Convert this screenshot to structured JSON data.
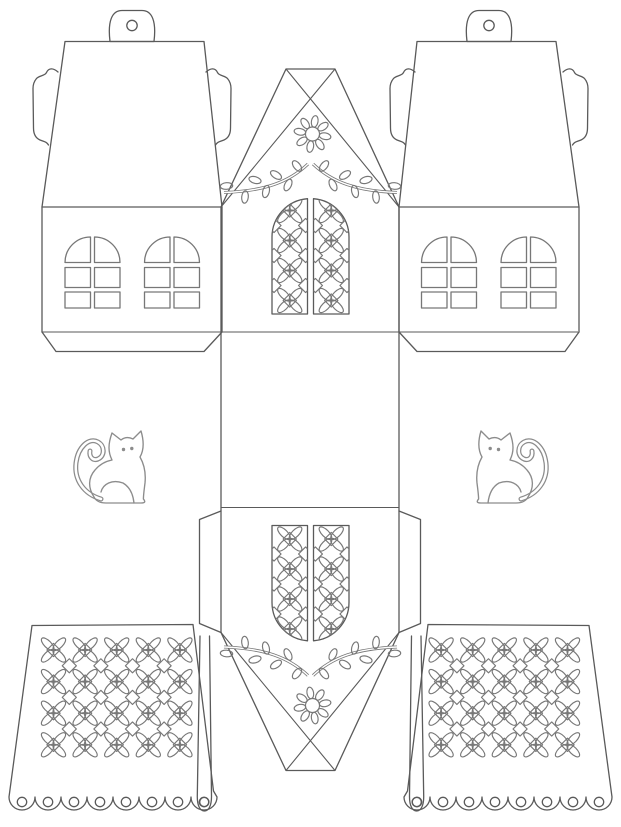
{
  "document": {
    "kind": "papercraft cut-out template",
    "subject": "cat house lantern template with lace fence panels",
    "canvas": {
      "width": 621,
      "height": 827
    }
  },
  "colors": {
    "paper": "#ffffff",
    "outline": "#5a5a5a",
    "pattern": "#777777",
    "window": "#777777",
    "cat": "#8c8c8c"
  },
  "parts": {
    "house_side_panels": {
      "count": 2,
      "windows_per_panel": 2,
      "panes_per_window": 6,
      "hanging_tab_holes": 1,
      "side_glue_tabs": 2,
      "bottom_flap": 1
    },
    "gable_strip": {
      "gable_faces": 2,
      "door_leaves_per_face": 2,
      "rosettes_per_door_leaf": 4,
      "flowers": 2,
      "flower_petals": 8,
      "leafy_branches": 4,
      "glue_tabs": 2,
      "hanging_straps_with_hole": 2
    },
    "cats": {
      "count": 2,
      "pose": "sitting with curled tail",
      "eyes_per_cat": 2
    },
    "lace_panels": {
      "count": 2,
      "rosette_columns": 5,
      "rosette_rows": 4,
      "interstitial_diamonds": 12,
      "scallops": 8,
      "punch_holes": 8
    }
  }
}
